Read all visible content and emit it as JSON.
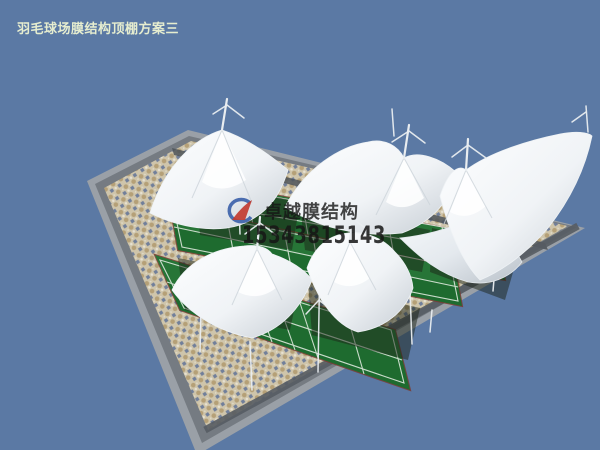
{
  "title": {
    "text": "羽毛球场膜结构顶棚方案三"
  },
  "watermark": {
    "logo_icon": "membrane-brand-logo",
    "brand": "卓越膜结构",
    "phone": "15343815143"
  },
  "scene": {
    "canopy_count": 5,
    "court_rows": 3
  },
  "colors": {
    "sky": "#5b79a4",
    "border_light": "#9aa0a7",
    "border_mid": "#757b82",
    "band_dark": "#4c5258",
    "mosaic_base": "#cfc5ab",
    "mosaic_blue": "#5a6e96",
    "mosaic_tan": "#b09a6e",
    "mosaic_light": "#e7e1d1",
    "court_green": "#1e6b2f",
    "court_green_light": "#2f8040",
    "court_line": "#e8efe6",
    "court_edge_red": "#7a3a30",
    "canopy_white": "#fbfcfd",
    "canopy_shade": "#c6cdd4",
    "canopy_shade2": "#b9c1c9",
    "mast": "#e9edf0",
    "shadow": "#1c2418",
    "logo_blue": "#3a5fa8",
    "logo_red": "#c23b30",
    "title_color": "#e6edcf",
    "watermark_color": "#161616"
  }
}
